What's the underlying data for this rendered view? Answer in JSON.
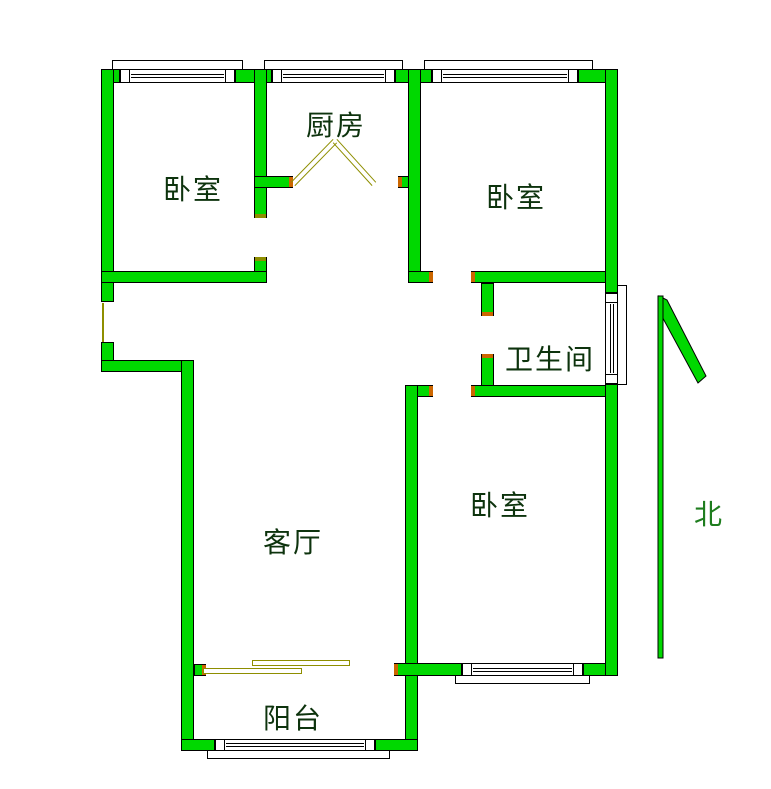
{
  "meta": {
    "canvas_width": 771,
    "canvas_height": 789
  },
  "colors": {
    "wall_fill": "#00d800",
    "wall_outline": "#000000",
    "door_line_olive": "#8e8e00",
    "jamb_mark_orange": "#cc6600",
    "room_label_color": "#0d330d",
    "north_label_color": "#1e7d1e",
    "background": "#ffffff"
  },
  "rooms": [
    {
      "id": "bedroom-1",
      "label": "卧室",
      "label_x": 193,
      "label_y": 190,
      "rect": {
        "x": 114,
        "y": 83,
        "w": 140,
        "h": 188
      }
    },
    {
      "id": "kitchen",
      "label": "厨房",
      "label_x": 336,
      "label_y": 126,
      "rect": {
        "x": 267,
        "y": 83,
        "w": 141,
        "h": 93
      }
    },
    {
      "id": "bedroom-2",
      "label": "卧室",
      "label_x": 516,
      "label_y": 198,
      "rect": {
        "x": 421,
        "y": 83,
        "w": 184,
        "h": 188
      }
    },
    {
      "id": "bathroom",
      "label": "卫生间",
      "label_x": 550,
      "label_y": 360,
      "rect": {
        "x": 494,
        "y": 283,
        "w": 111,
        "h": 102
      }
    },
    {
      "id": "living-room",
      "label": "客厅",
      "label_x": 293,
      "label_y": 543,
      "rect": {
        "x": 194,
        "y": 372,
        "w": 211,
        "h": 291
      }
    },
    {
      "id": "bedroom-3",
      "label": "卧室",
      "label_x": 500,
      "label_y": 506,
      "rect": {
        "x": 418,
        "y": 397,
        "w": 187,
        "h": 266
      }
    },
    {
      "id": "balcony",
      "label": "阳台",
      "label_x": 293,
      "label_y": 719,
      "rect": {
        "x": 194,
        "y": 676,
        "w": 211,
        "h": 63
      }
    }
  ],
  "north_indicator": {
    "label": "北",
    "label_x": 708,
    "label_y": 515,
    "shaft": {
      "x": 658,
      "y": 296,
      "w": 5,
      "h": 362
    },
    "barb_points": "659,296 667,300 706,376 698,383 659,311"
  },
  "walls": [
    {
      "x": 101,
      "y": 69,
      "w": 19,
      "h": 14
    },
    {
      "x": 235,
      "y": 69,
      "w": 37,
      "h": 14
    },
    {
      "x": 395,
      "y": 69,
      "w": 37,
      "h": 14
    },
    {
      "x": 578,
      "y": 69,
      "w": 40,
      "h": 14
    },
    {
      "x": 101,
      "y": 69,
      "w": 13,
      "h": 233
    },
    {
      "x": 101,
      "y": 342,
      "w": 13,
      "h": 30
    },
    {
      "x": 101,
      "y": 360,
      "w": 92,
      "h": 12
    },
    {
      "x": 181,
      "y": 360,
      "w": 13,
      "h": 391
    },
    {
      "x": 254,
      "y": 69,
      "w": 13,
      "h": 149
    },
    {
      "x": 254,
      "y": 257,
      "w": 13,
      "h": 26
    },
    {
      "x": 101,
      "y": 271,
      "w": 166,
      "h": 12
    },
    {
      "x": 254,
      "y": 176,
      "w": 39,
      "h": 12
    },
    {
      "x": 398,
      "y": 176,
      "w": 12,
      "h": 12
    },
    {
      "x": 408,
      "y": 69,
      "w": 13,
      "h": 214
    },
    {
      "x": 408,
      "y": 271,
      "w": 25,
      "h": 12
    },
    {
      "x": 471,
      "y": 271,
      "w": 147,
      "h": 12
    },
    {
      "x": 481,
      "y": 283,
      "w": 13,
      "h": 33
    },
    {
      "x": 481,
      "y": 354,
      "w": 13,
      "h": 43
    },
    {
      "x": 471,
      "y": 385,
      "w": 147,
      "h": 12
    },
    {
      "x": 405,
      "y": 385,
      "w": 28,
      "h": 12
    },
    {
      "x": 405,
      "y": 385,
      "w": 13,
      "h": 366
    },
    {
      "x": 394,
      "y": 663,
      "w": 68,
      "h": 13
    },
    {
      "x": 583,
      "y": 663,
      "w": 35,
      "h": 13
    },
    {
      "x": 194,
      "y": 664,
      "w": 12,
      "h": 12
    },
    {
      "x": 181,
      "y": 739,
      "w": 34,
      "h": 12
    },
    {
      "x": 375,
      "y": 739,
      "w": 43,
      "h": 12
    },
    {
      "x": 605,
      "y": 69,
      "w": 13,
      "h": 224
    },
    {
      "x": 605,
      "y": 384,
      "w": 13,
      "h": 292
    }
  ],
  "windows": [
    {
      "id": "window-bedroom-1-top",
      "dir": "h",
      "band": {
        "x": 120,
        "y": 69,
        "w": 115,
        "h": 14
      },
      "sill": {
        "x": 112,
        "y": 60,
        "w": 131,
        "h": 10
      }
    },
    {
      "id": "window-kitchen-top",
      "dir": "h",
      "band": {
        "x": 272,
        "y": 69,
        "w": 123,
        "h": 14
      },
      "sill": {
        "x": 264,
        "y": 60,
        "w": 139,
        "h": 10
      }
    },
    {
      "id": "window-bedroom-2-top",
      "dir": "h",
      "band": {
        "x": 432,
        "y": 69,
        "w": 146,
        "h": 14
      },
      "sill": {
        "x": 424,
        "y": 60,
        "w": 169,
        "h": 10
      }
    },
    {
      "id": "window-bathroom-right",
      "dir": "v",
      "band": {
        "x": 605,
        "y": 293,
        "w": 13,
        "h": 91
      },
      "sill": {
        "x": 617,
        "y": 285,
        "w": 10,
        "h": 100
      }
    },
    {
      "id": "window-bedroom-3-bottom",
      "dir": "h",
      "band": {
        "x": 462,
        "y": 663,
        "w": 121,
        "h": 13
      },
      "sill": {
        "x": 455,
        "y": 675,
        "w": 135,
        "h": 9
      }
    },
    {
      "id": "window-balcony-bottom",
      "dir": "h",
      "band": {
        "x": 215,
        "y": 739,
        "w": 160,
        "h": 12
      },
      "sill": {
        "x": 207,
        "y": 750,
        "w": 183,
        "h": 9
      }
    }
  ],
  "door_marks": {
    "kitchen_swing_segments": [
      {
        "x1": 293,
        "y1": 184,
        "x2": 335,
        "y2": 141
      },
      {
        "x1": 335,
        "y1": 141,
        "x2": 374,
        "y2": 184
      }
    ],
    "balcony_sliding_bars": [
      {
        "x": 252,
        "y": 660,
        "w": 98,
        "h": 6
      },
      {
        "x": 203,
        "y": 668,
        "w": 99,
        "h": 6
      }
    ],
    "hall_opening_line": {
      "x": 102,
      "y": 303,
      "w": 2,
      "h": 39
    },
    "jamb_ticks": [
      {
        "x": 289,
        "y": 177,
        "w": 4,
        "h": 10,
        "color": "#cc6600"
      },
      {
        "x": 398,
        "y": 177,
        "w": 4,
        "h": 10,
        "color": "#cc6600"
      },
      {
        "x": 429,
        "y": 272,
        "w": 4,
        "h": 10,
        "color": "#cc6600"
      },
      {
        "x": 471,
        "y": 272,
        "w": 4,
        "h": 10,
        "color": "#cc6600"
      },
      {
        "x": 482,
        "y": 312,
        "w": 11,
        "h": 4,
        "color": "#cc6600"
      },
      {
        "x": 482,
        "y": 354,
        "w": 11,
        "h": 4,
        "color": "#cc6600"
      },
      {
        "x": 471,
        "y": 386,
        "w": 4,
        "h": 10,
        "color": "#cc6600"
      },
      {
        "x": 429,
        "y": 386,
        "w": 4,
        "h": 10,
        "color": "#cc6600"
      },
      {
        "x": 255,
        "y": 214,
        "w": 11,
        "h": 4,
        "color": "#8e8e00"
      },
      {
        "x": 255,
        "y": 257,
        "w": 11,
        "h": 4,
        "color": "#8e8e00"
      },
      {
        "x": 202,
        "y": 665,
        "w": 4,
        "h": 10,
        "color": "#cc6600"
      },
      {
        "x": 394,
        "y": 664,
        "w": 4,
        "h": 11,
        "color": "#cc6600"
      }
    ]
  }
}
